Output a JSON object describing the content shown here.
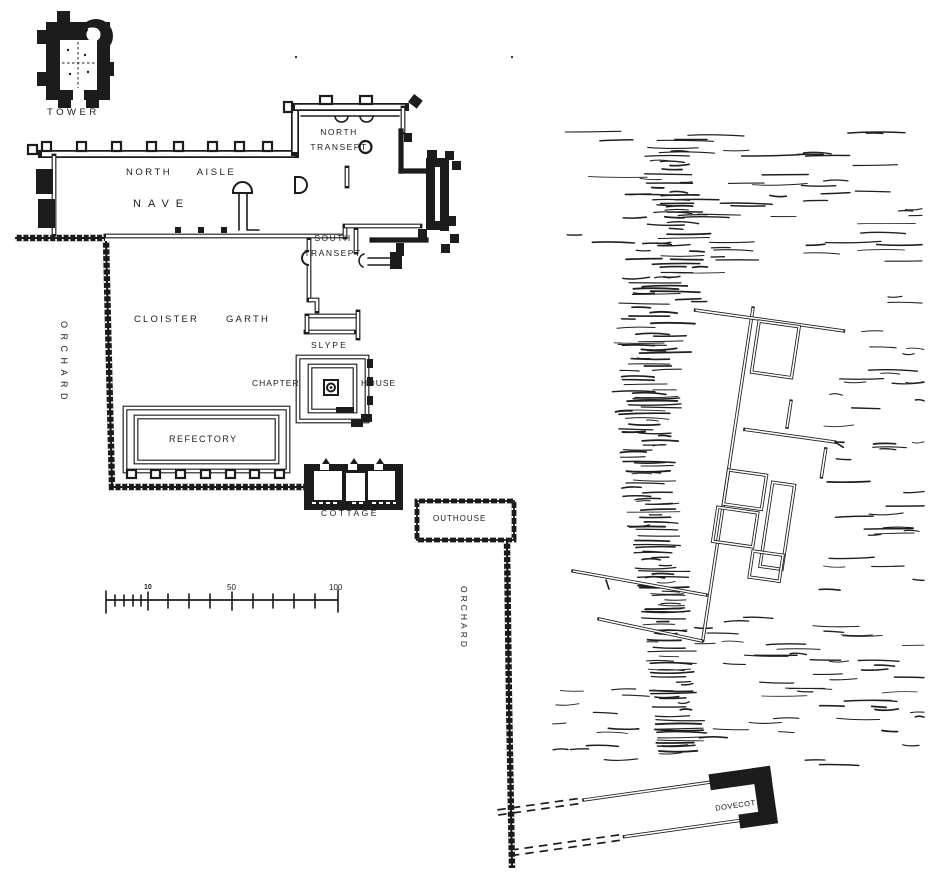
{
  "figure": {
    "kind": "monastic-site-plan",
    "ink_color": "#1c1c1c",
    "paper_color": "#ffffff"
  },
  "labels": {
    "tower": "TOWER",
    "north_aisle": "NORTH AISLE",
    "nave": "NAVE",
    "north_transept": {
      "line1": "NORTH",
      "line2": "TRANSEPT"
    },
    "south_transept": {
      "line1": "SOUTH",
      "line2": "TRANSEPT"
    },
    "cloister_garth": "CLOISTER GARTH",
    "slype": "SLYPE",
    "chapter_house": {
      "left": "CHAPTER",
      "right": "HOUSE"
    },
    "refectory": "REFECTORY",
    "cottage": "COTTAGE",
    "outhouse": "OUTHOUSE",
    "orchard_west": "ORCHARD",
    "orchard_east": "ORCHARD",
    "dovecot": "DOVECOT"
  },
  "scale_bar": {
    "labels": [
      "10",
      "50",
      "100"
    ]
  }
}
